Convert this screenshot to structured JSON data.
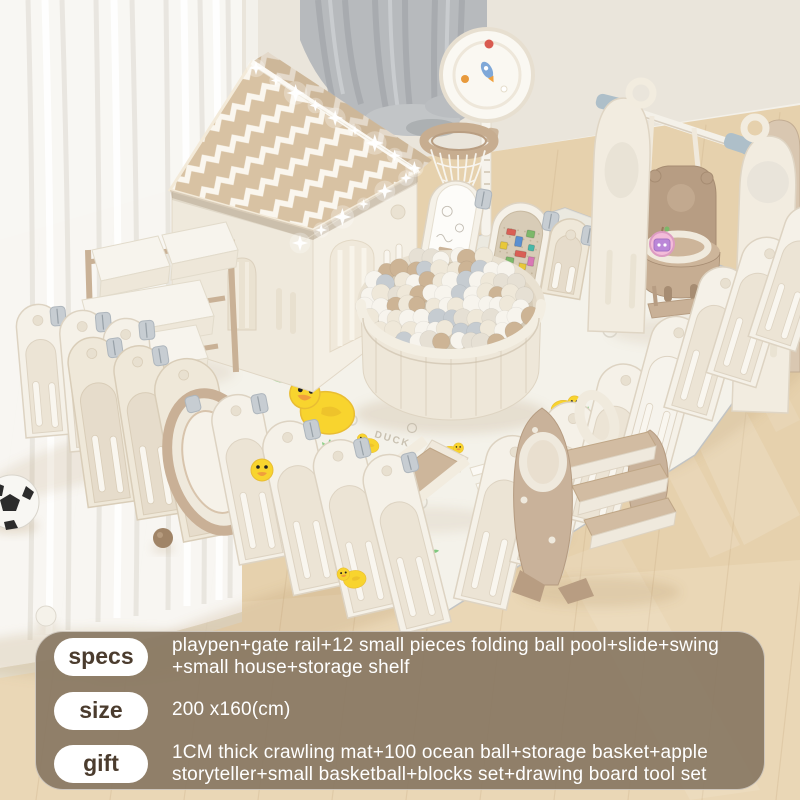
{
  "product_photo": {
    "mat_brand": "DUCK",
    "colors": {
      "wall": "#eae5db",
      "baseboard": "#f3f0e9",
      "floor": "#e6d1ad",
      "floor_warm": "#eddcbd",
      "plank": "#c9ac84",
      "sheer_curtain": "#f8f7f4",
      "gray_curtain": "#b7babd",
      "fence_white": "#f5f1e8",
      "fence_cream": "#efe8d9",
      "fence_line": "#ddd3c2",
      "roof_beige": "#d8c2a3",
      "roof_white": "#faf6ee",
      "wood_tan": "#cbb499",
      "seat_brown": "#b79d83",
      "duck_yellow": "#f8d42e",
      "duck_beak": "#f09f3c",
      "grass_green": "#7ec87e",
      "apple_pink": "#f3bcd9",
      "hinge_gray": "#c7cdd2",
      "connector_blue": "#aebfc9",
      "mat": "#f4f2ea",
      "ball_colors": [
        "#f7f4ed",
        "#efe8d9",
        "#c6ccd1",
        "#cdb495",
        "#e6e0d4"
      ],
      "panel_bg": "rgba(137,121,99,0.93)",
      "pill_bg": "#ffffff",
      "pill_text": "#4b3c2e",
      "info_text": "#ffffff"
    }
  },
  "info_panel": {
    "rows": [
      {
        "label": "specs",
        "text": "playpen+gate rail+12 small pieces folding ball pool+slide+swing +small house+storage shelf"
      },
      {
        "label": "size",
        "text": "200 x160(cm)"
      },
      {
        "label": "gift",
        "text": "1CM thick crawling mat+100 ocean ball+storage basket+apple storyteller+small basketball+blocks set+drawing board tool set"
      }
    ]
  }
}
